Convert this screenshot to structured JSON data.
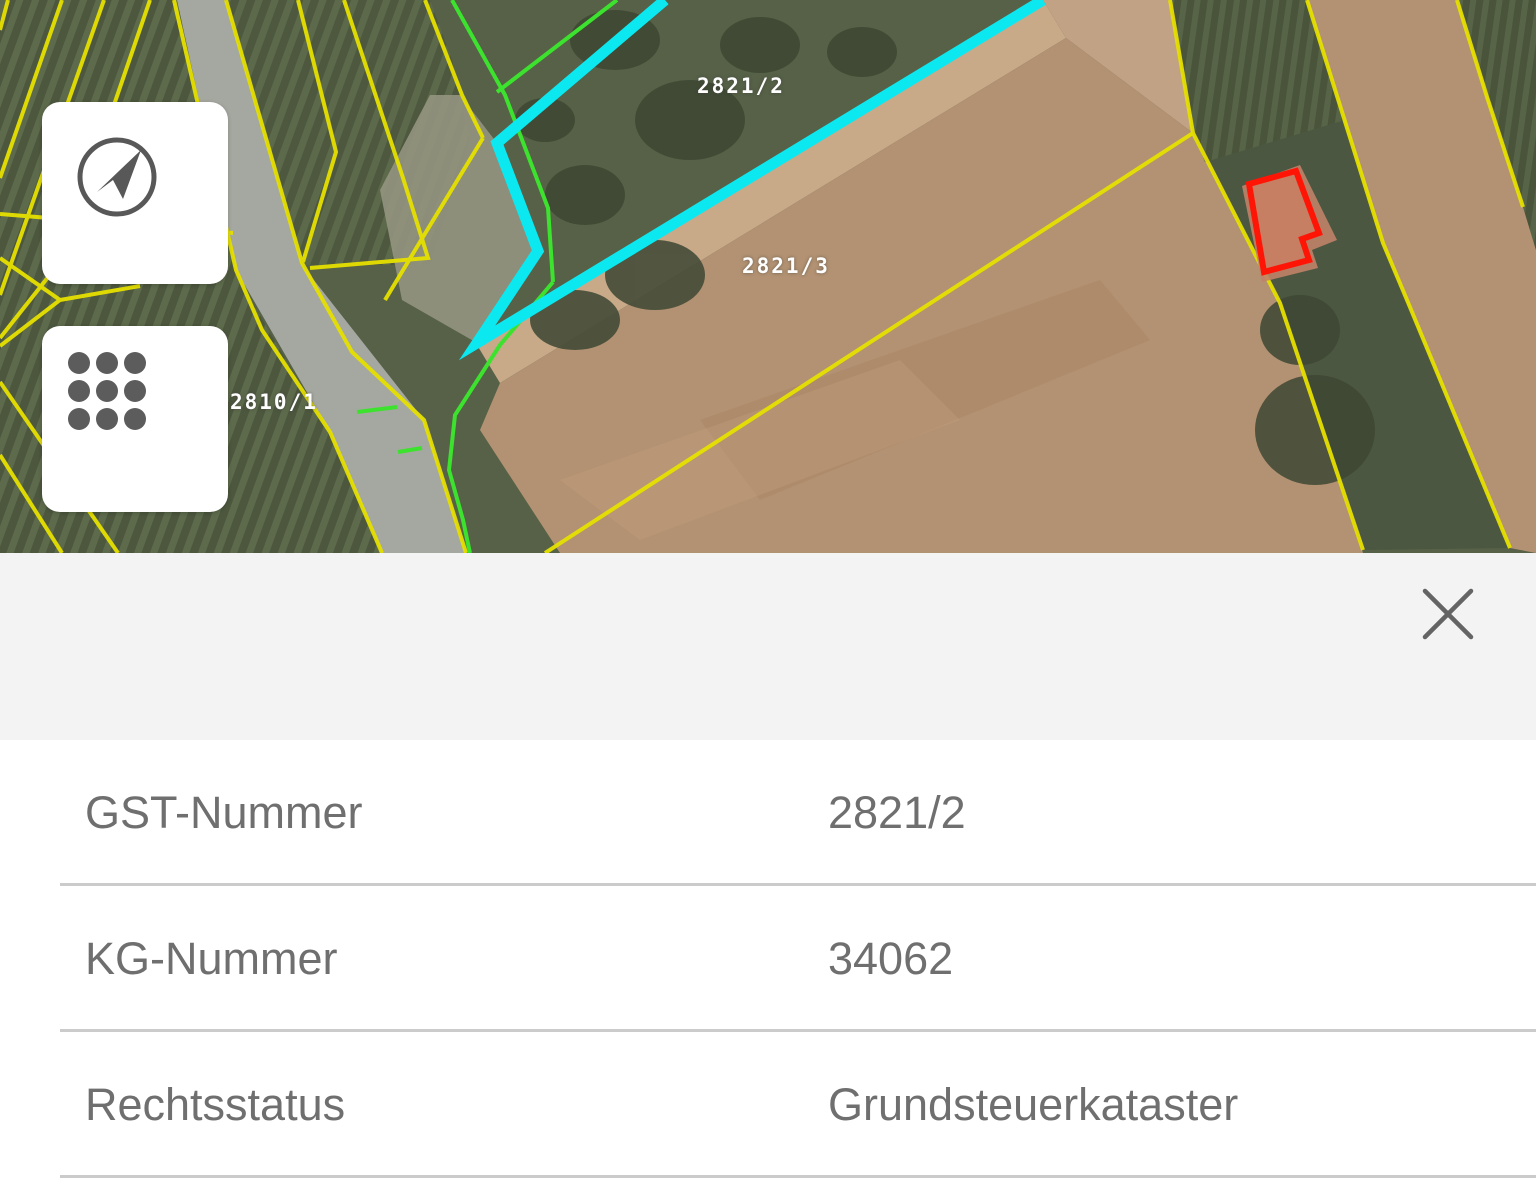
{
  "map": {
    "parcel_labels": [
      {
        "text": "2821/2"
      },
      {
        "text": "2821/3"
      },
      {
        "text": "2810/1"
      }
    ],
    "controls": {
      "locate_icon": "location-arrow-icon",
      "grid_icon": "grid-dots-icon"
    },
    "colors": {
      "selected_parcel_outline": "#0ce8f0",
      "parcel_boundary_yellow": "#e6e000",
      "parcel_boundary_green": "#3ce22e",
      "building_outline_red": "#ff1506",
      "field_brown": "#b29272",
      "vineyard_green": "#4c573e",
      "road_grey": "#a5a8a0"
    }
  },
  "panel": {
    "background": "#f3f3f4",
    "close_icon": "close-icon",
    "rows": [
      {
        "label": "GST-Nummer",
        "value": "2821/2"
      },
      {
        "label": "KG-Nummer",
        "value": "34062"
      },
      {
        "label": "Rechtsstatus",
        "value": "Grundsteuerkataster"
      }
    ]
  }
}
